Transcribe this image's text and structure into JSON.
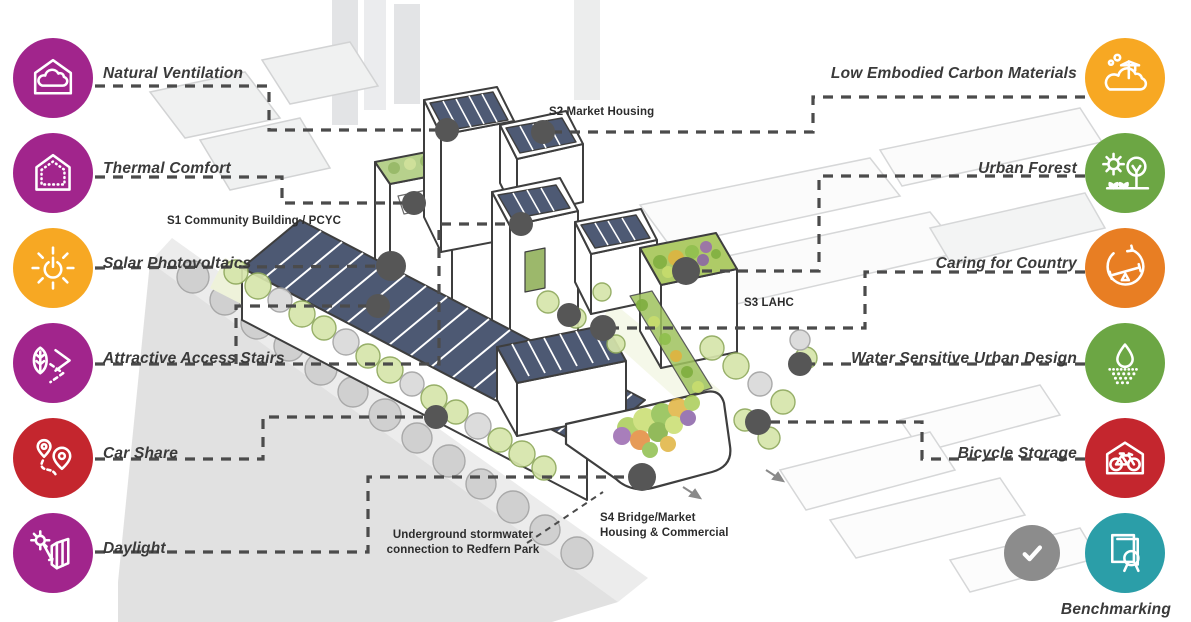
{
  "title": "Sustainability features diagram",
  "palette": {
    "magenta": "#A1258C",
    "amber": "#F7A823",
    "red": "#C4262E",
    "green": "#6CA644",
    "orange": "#E87E23",
    "teal": "#2B9EA8",
    "check_gray": "#8C8C8C",
    "dot": "#565656",
    "line": "#4B4B4B"
  },
  "features_left": [
    {
      "label": "Natural Ventilation",
      "color": "#A1258C",
      "icon": "house-cloud-icon"
    },
    {
      "label": "Thermal Comfort",
      "color": "#A1258C",
      "icon": "insulated-house-icon"
    },
    {
      "label": "Solar Photovoltaics",
      "color": "#F7A823",
      "icon": "sun-power-icon"
    },
    {
      "label": "Attractive Access Stairs",
      "color": "#A1258C",
      "icon": "leaf-chevrons-icon"
    },
    {
      "label": "Car Share",
      "color": "#C4262E",
      "icon": "map-pins-icon"
    },
    {
      "label": "Daylight",
      "color": "#A1258C",
      "icon": "sun-building-icon"
    }
  ],
  "features_right": [
    {
      "label": "Low Embodied Carbon Materials",
      "color": "#F7A823",
      "icon": "cloud-crane-icon"
    },
    {
      "label": "Urban Forest",
      "color": "#6CA644",
      "icon": "sun-tree-icon"
    },
    {
      "label": "Caring for Country",
      "color": "#E87E23",
      "icon": "cycle-seesaw-icon"
    },
    {
      "label": "Water Sensitive Urban Design",
      "color": "#6CA644",
      "icon": "raindrop-icon"
    },
    {
      "label": "Bicycle Storage",
      "color": "#C4262E",
      "icon": "bike-shed-icon"
    },
    {
      "label": "Benchmarking",
      "color": "#2B9EA8",
      "icon": "certificate-icon"
    }
  ],
  "checkmark": {
    "name": "completed-check",
    "color": "#8C8C8C"
  },
  "building_labels": [
    {
      "text": "S2 Market Housing",
      "x": 549,
      "y": 105,
      "align": "left"
    },
    {
      "text": "S1 Community Building / PCYC",
      "x": 167,
      "y": 214,
      "align": "left"
    },
    {
      "text": "S3 LAHC",
      "x": 744,
      "y": 296,
      "align": "left"
    },
    {
      "text": "S4 Bridge/Market\nHousing & Commercial",
      "x": 600,
      "y": 511,
      "align": "left"
    },
    {
      "text": "Underground stormwater\nconnection to Redfern Park",
      "x": 463,
      "y": 528,
      "align": "center"
    }
  ],
  "connectors": [
    {
      "name": "natural-ventilation-line",
      "points": [
        [
          95,
          86
        ],
        [
          269,
          86
        ],
        [
          269,
          130
        ],
        [
          447,
          130
        ]
      ]
    },
    {
      "name": "low-embodied-carbon-line",
      "points": [
        [
          1085,
          97
        ],
        [
          813,
          97
        ],
        [
          813,
          132
        ],
        [
          543,
          132
        ]
      ]
    },
    {
      "name": "thermal-comfort-line",
      "points": [
        [
          95,
          177
        ],
        [
          282,
          177
        ],
        [
          282,
          203
        ],
        [
          414,
          203
        ]
      ]
    },
    {
      "name": "urban-forest-line",
      "points": [
        [
          1085,
          176
        ],
        [
          819,
          176
        ],
        [
          819,
          271
        ],
        [
          686,
          271
        ]
      ]
    },
    {
      "name": "solar-photovoltaics-line",
      "points": [
        [
          95,
          268
        ],
        [
          391,
          266
        ]
      ]
    },
    {
      "name": "caring-for-country-line",
      "points": [
        [
          1085,
          272
        ],
        [
          865,
          272
        ],
        [
          865,
          328
        ],
        [
          603,
          328
        ]
      ]
    },
    {
      "name": "access-stairs-line",
      "points": [
        [
          95,
          364
        ],
        [
          439,
          364
        ],
        [
          439,
          224
        ],
        [
          521,
          224
        ]
      ]
    },
    {
      "name": "access-stairs-branch-line",
      "points": [
        [
          236,
          364
        ],
        [
          236,
          306
        ],
        [
          378,
          306
        ]
      ]
    },
    {
      "name": "water-sensitive-line",
      "points": [
        [
          1085,
          364
        ],
        [
          800,
          364
        ]
      ]
    },
    {
      "name": "car-share-line",
      "points": [
        [
          95,
          459
        ],
        [
          263,
          459
        ],
        [
          263,
          417
        ],
        [
          436,
          417
        ]
      ]
    },
    {
      "name": "bicycle-storage-line",
      "points": [
        [
          1085,
          459
        ],
        [
          922,
          459
        ],
        [
          922,
          422
        ],
        [
          758,
          422
        ]
      ]
    },
    {
      "name": "daylight-line",
      "points": [
        [
          95,
          552
        ],
        [
          368,
          552
        ],
        [
          368,
          477
        ],
        [
          642,
          477
        ]
      ]
    },
    {
      "name": "stormwater-line",
      "points": [
        [
          527,
          543
        ],
        [
          603,
          492
        ]
      ],
      "dash": "6 5",
      "width": 2
    }
  ],
  "dots": [
    {
      "x": 447,
      "y": 130,
      "r": 12
    },
    {
      "x": 543,
      "y": 132,
      "r": 12
    },
    {
      "x": 414,
      "y": 203,
      "r": 12
    },
    {
      "x": 521,
      "y": 224,
      "r": 12
    },
    {
      "x": 391,
      "y": 266,
      "r": 15
    },
    {
      "x": 378,
      "y": 306,
      "r": 12
    },
    {
      "x": 436,
      "y": 417,
      "r": 12
    },
    {
      "x": 642,
      "y": 477,
      "r": 14
    },
    {
      "x": 686,
      "y": 271,
      "r": 14
    },
    {
      "x": 603,
      "y": 328,
      "r": 13
    },
    {
      "x": 800,
      "y": 364,
      "r": 12
    },
    {
      "x": 758,
      "y": 422,
      "r": 13
    },
    {
      "x": 569,
      "y": 315,
      "r": 12
    }
  ]
}
